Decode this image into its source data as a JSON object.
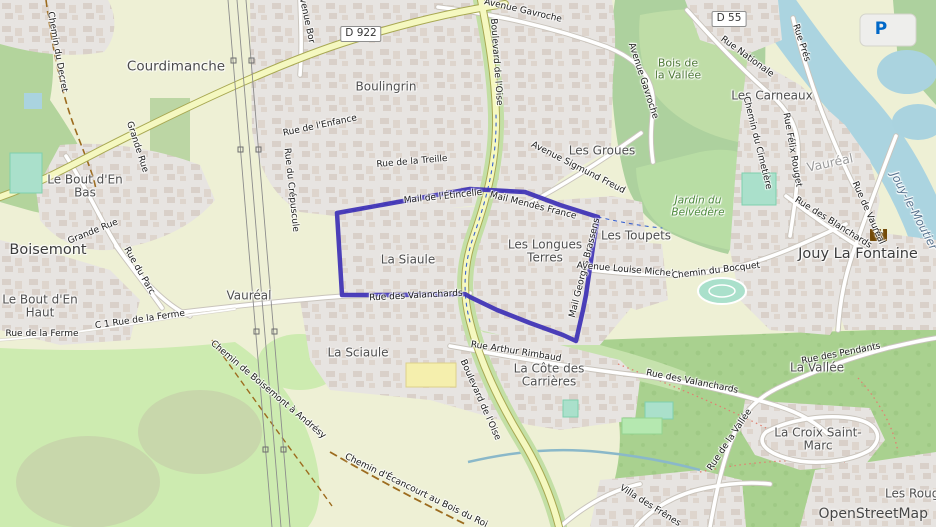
{
  "map": {
    "attribution": "OpenStreetMap",
    "parking": {
      "glyph": "P"
    },
    "badges": [
      {
        "text": "D 922",
        "x": 361,
        "y": 34
      },
      {
        "text": "D 55",
        "x": 729,
        "y": 19
      }
    ],
    "highlight": {
      "color": "#3d30b5",
      "points": [
        [
          337,
          213
        ],
        [
          420,
          198
        ],
        [
          470,
          189
        ],
        [
          525,
          192
        ],
        [
          560,
          205
        ],
        [
          598,
          217
        ],
        [
          594,
          240
        ],
        [
          586,
          295
        ],
        [
          583,
          310
        ],
        [
          576,
          341
        ],
        [
          563,
          335
        ],
        [
          530,
          323
        ],
        [
          497,
          310
        ],
        [
          470,
          297
        ],
        [
          465,
          294
        ],
        [
          400,
          295
        ],
        [
          342,
          295
        ]
      ]
    },
    "labels": [
      {
        "text": "Courdimanche",
        "x": 176,
        "y": 67,
        "cls": "town"
      },
      {
        "text": "Boisemont",
        "x": 48,
        "y": 250,
        "cls": "city"
      },
      {
        "text": "Jouy La Fontaine",
        "x": 858,
        "y": 254,
        "cls": "city"
      },
      {
        "text": "Vauréal",
        "x": 830,
        "y": 163,
        "rot": -12,
        "cls": "faded"
      },
      {
        "text": "Vauréal",
        "x": 249,
        "y": 296,
        "cls": "suburb"
      },
      {
        "text": "Boulingrin",
        "x": 386,
        "y": 87,
        "cls": "suburb"
      },
      {
        "text": "Les Groues",
        "x": 602,
        "y": 151,
        "cls": "suburb"
      },
      {
        "text": "Les Toupets",
        "x": 636,
        "y": 236,
        "cls": "suburb"
      },
      {
        "text": "La Siaule",
        "x": 408,
        "y": 260,
        "cls": "suburb"
      },
      {
        "text": "La Sciaule",
        "x": 358,
        "y": 353,
        "cls": "suburb"
      },
      {
        "text": "Les Carneaux",
        "x": 772,
        "y": 96,
        "cls": "suburb"
      },
      {
        "text": "La Vallée",
        "x": 817,
        "y": 368,
        "cls": "suburb"
      },
      {
        "text": "Les Rouges",
        "x": 919,
        "y": 494,
        "cls": "suburb"
      },
      {
        "text": "Le Bout d'En Bas",
        "lines": [
          "Le Bout d'En",
          "Bas"
        ],
        "x": 85,
        "y": 187,
        "cls": "suburb"
      },
      {
        "text": "Le Bout d'En Haut",
        "lines": [
          "Le Bout d'En",
          "Haut"
        ],
        "x": 40,
        "y": 307,
        "cls": "suburb"
      },
      {
        "text": "Les Longues Terres",
        "lines": [
          "Les Longues",
          "Terres"
        ],
        "x": 545,
        "y": 252,
        "cls": "suburb"
      },
      {
        "text": "La Côte des Carrières",
        "lines": [
          "La Côte des",
          "Carrières"
        ],
        "x": 549,
        "y": 376,
        "cls": "suburb"
      },
      {
        "text": "La Croix Saint-Marc",
        "lines": [
          "La Croix Saint-",
          "Marc"
        ],
        "x": 818,
        "y": 440,
        "cls": "suburb"
      },
      {
        "text": "Jouy-le-Moutier",
        "x": 914,
        "y": 211,
        "rot": 62,
        "cls": "water"
      },
      {
        "text": "Bois de la Vallée",
        "lines": [
          "Bois de",
          "la Vallée"
        ],
        "x": 678,
        "y": 70,
        "cls": "wood"
      },
      {
        "text": "Jardin du Belvédère",
        "lines": [
          "Jardin du",
          "Belvédère"
        ],
        "x": 698,
        "y": 207,
        "cls": "park"
      },
      {
        "text": "Chemin du Decret",
        "x": 57,
        "y": 52,
        "rot": 80,
        "cls": "street"
      },
      {
        "text": "Grande Rue",
        "x": 137,
        "y": 147,
        "rot": 72,
        "cls": "street"
      },
      {
        "text": "Grande Rue",
        "x": 93,
        "y": 232,
        "rot": -22,
        "cls": "street"
      },
      {
        "text": "Rue du Parc",
        "x": 139,
        "y": 271,
        "rot": 60,
        "cls": "street"
      },
      {
        "text": "Rue de la Ferme",
        "x": 42,
        "y": 334,
        "rot": 0,
        "cls": "street"
      },
      {
        "text": "C 1 Rue de la Ferme",
        "x": 140,
        "y": 320,
        "rot": -8,
        "cls": "street"
      },
      {
        "text": "Chemin de Boisemont à Andrésy",
        "x": 268,
        "y": 390,
        "rot": 40,
        "cls": "street"
      },
      {
        "text": "Chemin d'Écancourt au Bois du Roi",
        "x": 416,
        "y": 491,
        "rot": 26,
        "cls": "street"
      },
      {
        "text": "Rue du Crépuscule",
        "x": 291,
        "y": 190,
        "rot": 84,
        "cls": "street"
      },
      {
        "text": "Avenue Bor",
        "x": 306,
        "y": 18,
        "rot": 78,
        "cls": "street"
      },
      {
        "text": "Rue de l'Enfance",
        "x": 320,
        "y": 126,
        "rot": -12,
        "cls": "street"
      },
      {
        "text": "Rue de la Treille",
        "x": 412,
        "y": 162,
        "rot": -5,
        "cls": "street"
      },
      {
        "text": "Mail de l'Étincelle",
        "x": 443,
        "y": 197,
        "rot": -6,
        "cls": "street"
      },
      {
        "text": "Mail Mendès France",
        "x": 533,
        "y": 206,
        "rot": 14,
        "cls": "street"
      },
      {
        "text": "Mail Georges Brassens",
        "x": 585,
        "y": 268,
        "rot": -76,
        "cls": "street"
      },
      {
        "text": "Rue des Valanchards",
        "x": 416,
        "y": 296,
        "rot": -3,
        "cls": "street"
      },
      {
        "text": "Rue Arthur Rimbaud",
        "x": 516,
        "y": 352,
        "rot": 9,
        "cls": "street"
      },
      {
        "text": "Rue des Valanchards",
        "x": 692,
        "y": 382,
        "rot": 11,
        "cls": "street"
      },
      {
        "text": "Boulevard de l'Oise",
        "x": 496,
        "y": 62,
        "rot": 86,
        "cls": "street"
      },
      {
        "text": "Boulevard de l'Oise",
        "x": 480,
        "y": 400,
        "rot": 66,
        "cls": "street"
      },
      {
        "text": "Avenue Gavroche",
        "x": 523,
        "y": 11,
        "rot": 13,
        "cls": "street"
      },
      {
        "text": "Avenue Gavroche",
        "x": 643,
        "y": 81,
        "rot": 72,
        "cls": "street"
      },
      {
        "text": "Avenue Sigmund Freud",
        "x": 578,
        "y": 168,
        "rot": 27,
        "cls": "street"
      },
      {
        "text": "Avenue Louise Michel",
        "x": 625,
        "y": 270,
        "rot": 5,
        "cls": "street"
      },
      {
        "text": "Chemin du Bocquet",
        "x": 716,
        "y": 271,
        "rot": -7,
        "cls": "street"
      },
      {
        "text": "Rue Nationale",
        "x": 747,
        "y": 57,
        "rot": 36,
        "cls": "street"
      },
      {
        "text": "Rue Prés",
        "x": 801,
        "y": 43,
        "rot": 72,
        "cls": "street"
      },
      {
        "text": "Chemin du Cimetière",
        "x": 757,
        "y": 143,
        "rot": 76,
        "cls": "street"
      },
      {
        "text": "Rue Félix Rouget",
        "x": 792,
        "y": 150,
        "rot": 80,
        "cls": "street"
      },
      {
        "text": "Rue de Vauréal",
        "x": 868,
        "y": 213,
        "rot": 66,
        "cls": "street"
      },
      {
        "text": "Rue des Blanchards",
        "x": 833,
        "y": 223,
        "rot": 32,
        "cls": "street"
      },
      {
        "text": "Rue des Pendants",
        "x": 841,
        "y": 354,
        "rot": -11,
        "cls": "street"
      },
      {
        "text": "Rue de la Vallée",
        "x": 730,
        "y": 440,
        "rot": -56,
        "cls": "street"
      },
      {
        "text": "Villa des Frênes",
        "x": 650,
        "y": 506,
        "rot": 32,
        "cls": "street"
      }
    ]
  }
}
